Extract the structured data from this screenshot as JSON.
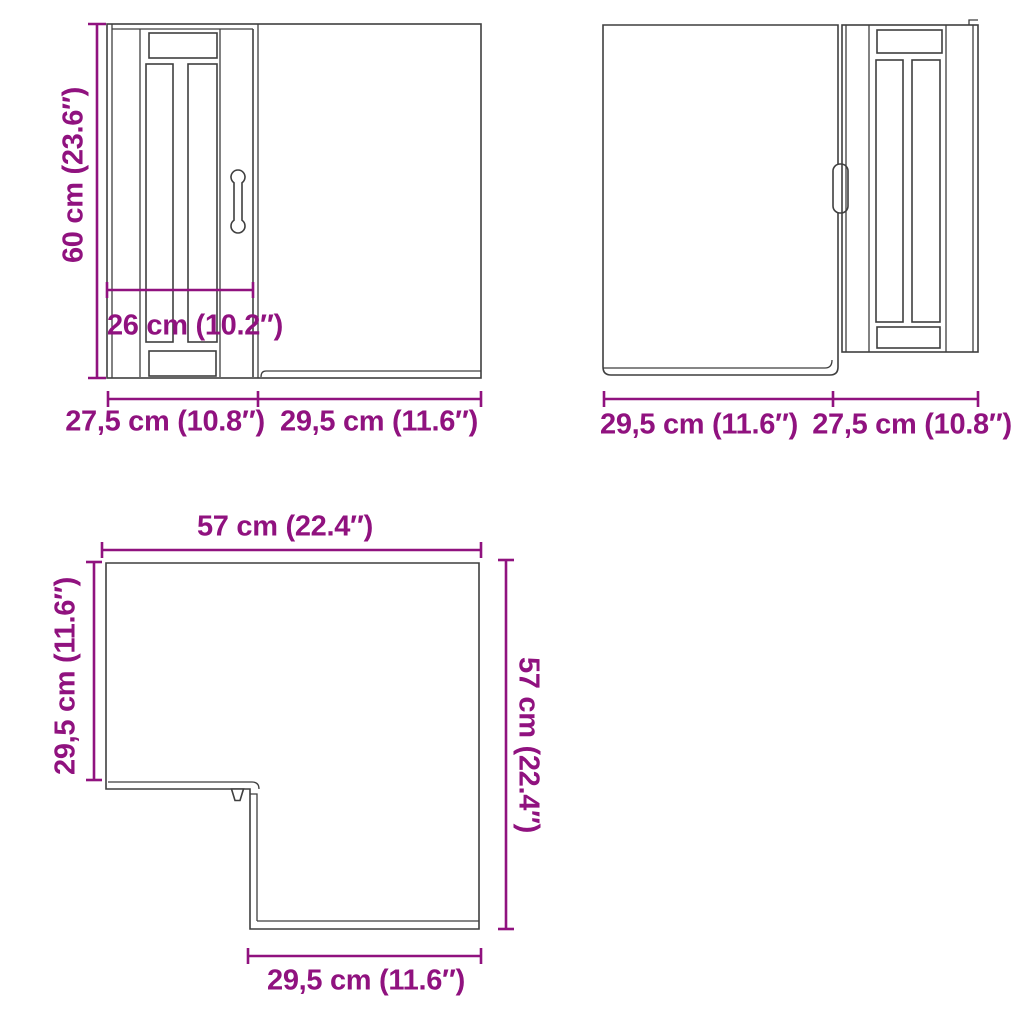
{
  "colors": {
    "dimension": "#90127f",
    "drawing_line": "#3f3f3f",
    "background": "#ffffff"
  },
  "front_left_view": {
    "height_label": "60 cm (23.6″)",
    "inner_width_label": "26 cm (10.2″)",
    "door_width_label": "27,5 cm (10.8″)",
    "side_width_label": "29,5 cm (11.6″)"
  },
  "front_right_view": {
    "side_width_label": "29,5 cm (11.6″)",
    "door_width_label": "27,5 cm (10.8″)"
  },
  "top_view": {
    "width_label": "57 cm (22.4″)",
    "left_depth_label": "29,5 cm (11.6″)",
    "right_height_label": "57 cm (22.4″)",
    "bottom_depth_label": "29,5 cm (11.6″)"
  }
}
